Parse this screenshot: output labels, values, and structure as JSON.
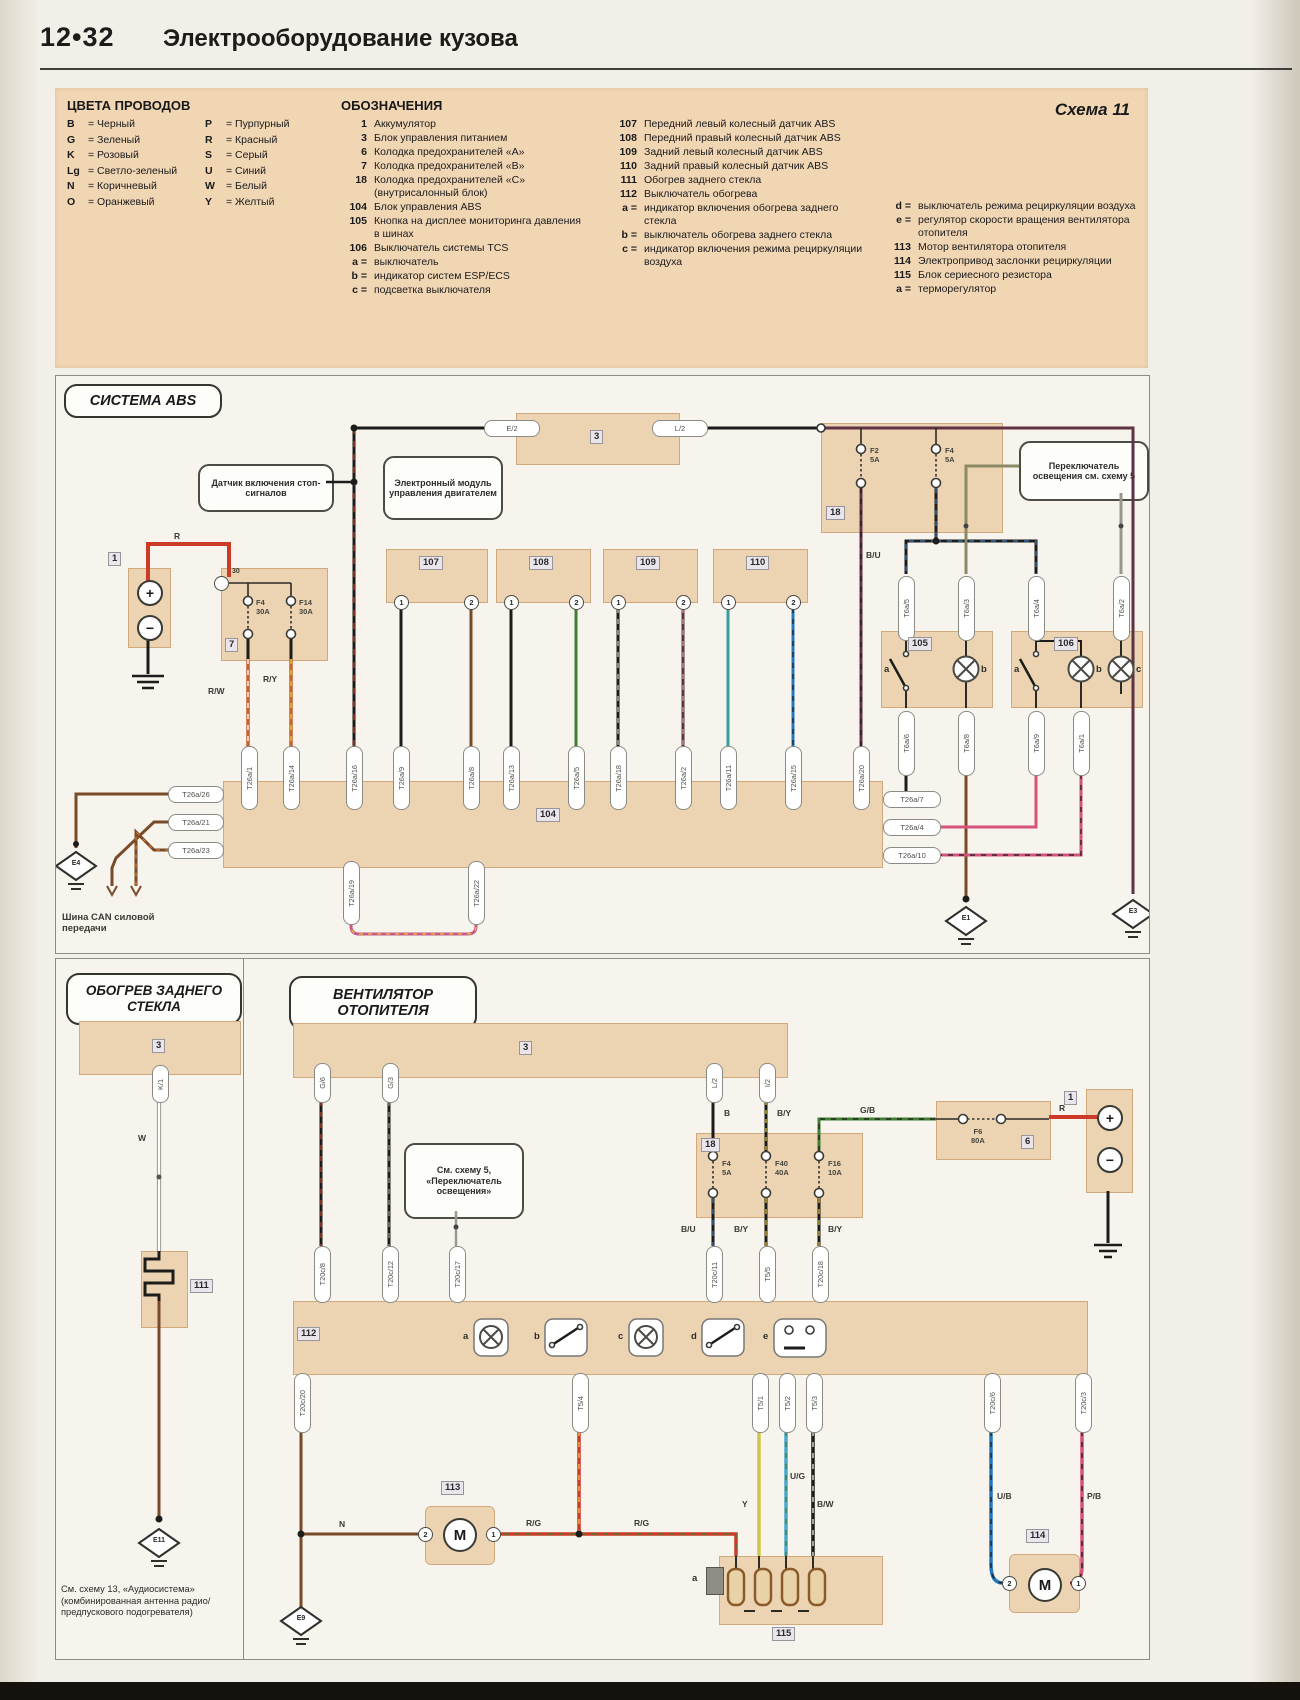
{
  "header": {
    "page_no": "12•32",
    "title": "Электрооборудование кузова"
  },
  "sym": {
    "plus": "+",
    "minus": "−",
    "m": "M"
  },
  "legend": {
    "scheme_label": "Схема 11",
    "wire_colors_title": "ЦВЕТА ПРОВОДОВ",
    "designations_title": "ОБОЗНАЧЕНИЯ",
    "wire_colors_col1": [
      {
        "code": "B",
        "name": "= Черный"
      },
      {
        "code": "G",
        "name": "= Зеленый"
      },
      {
        "code": "K",
        "name": "= Розовый"
      },
      {
        "code": "Lg",
        "name": "= Светло-зеленый"
      },
      {
        "code": "N",
        "name": "= Коричневый"
      },
      {
        "code": "O",
        "name": "= Оранжевый"
      }
    ],
    "wire_colors_col2": [
      {
        "code": "P",
        "name": "= Пурпурный"
      },
      {
        "code": "R",
        "name": "= Красный"
      },
      {
        "code": "S",
        "name": "= Серый"
      },
      {
        "code": "U",
        "name": "= Синий"
      },
      {
        "code": "W",
        "name": "= Белый"
      },
      {
        "code": "Y",
        "name": "= Желтый"
      }
    ],
    "designations_col1": [
      {
        "n": "1",
        "t": "Аккумулятор"
      },
      {
        "n": "3",
        "t": "Блок управления питанием"
      },
      {
        "n": "6",
        "t": "Колодка предохранителей «А»"
      },
      {
        "n": "7",
        "t": "Колодка предохранителей «В»"
      },
      {
        "n": "18",
        "t": "Колодка предохранителей «С» (внутрисалонный блок)"
      },
      {
        "n": "104",
        "t": "Блок управления ABS"
      },
      {
        "n": "105",
        "t": "Кнопка на дисплее мониторинга давления в шинах"
      },
      {
        "n": "106",
        "t": "Выключатель системы TCS"
      },
      {
        "n": "a =",
        "t": "выключатель"
      },
      {
        "n": "b =",
        "t": "индикатор систем ESP/ECS"
      },
      {
        "n": "c =",
        "t": "подсветка выключателя"
      }
    ],
    "designations_col2": [
      {
        "n": "107",
        "t": "Передний левый колесный датчик ABS"
      },
      {
        "n": "108",
        "t": "Передний правый колесный датчик ABS"
      },
      {
        "n": "109",
        "t": "Задний левый колесный датчик ABS"
      },
      {
        "n": "110",
        "t": "Задний правый колесный датчик ABS"
      },
      {
        "n": "111",
        "t": "Обогрев заднего стекла"
      },
      {
        "n": "112",
        "t": "Выключатель обогрева"
      },
      {
        "n": "a =",
        "t": "индикатор включения обогрева заднего стекла"
      },
      {
        "n": "b =",
        "t": "выключатель обогрева заднего стекла"
      },
      {
        "n": "c =",
        "t": "индикатор включения режима рециркуляции воздуха"
      }
    ],
    "designations_col3": [
      {
        "n": "d =",
        "t": "выключатель режима рециркуляции воздуха"
      },
      {
        "n": "e =",
        "t": "регулятор скорости вращения вентилятора отопителя"
      },
      {
        "n": "113",
        "t": "Мотор вентилятора отопителя"
      },
      {
        "n": "114",
        "t": "Электропривод заслонки рециркуляции"
      },
      {
        "n": "115",
        "t": "Блок сериесного резистора"
      },
      {
        "n": "a =",
        "t": "терморегулятор"
      }
    ]
  },
  "abs": {
    "section_title": "СИСТЕМА ABS",
    "callout_stop": "Датчик включения стоп-сигналов",
    "callout_ecm": "Электронный модуль управления двигателем",
    "callout_light": "Переключатель освещения см. схему 5",
    "blocks": {
      "battery": "1",
      "fusebox7": "7",
      "power3": "3",
      "fusebox18": "18",
      "ctrl104": "104",
      "disp105": "105",
      "tcs106": "106",
      "s107": "107",
      "s108": "108",
      "s109": "109",
      "s110": "110"
    },
    "pins": {
      "p30": "30",
      "e2": "E/2",
      "l2": "L/2",
      "pin1": "1",
      "pin2": "2"
    },
    "fuses": {
      "f4": "F4",
      "f4a": "30A",
      "f14": "F14",
      "f14a": "30A",
      "f2": "F2",
      "f2a": "5A",
      "f4b": "F4",
      "f4ba": "5A"
    },
    "wire_labels": {
      "r": "R",
      "rw": "R/W",
      "ry": "R/Y",
      "bu": "B/U"
    },
    "connectors_top": [
      "T26a/1",
      "T26a/14",
      "T26a/16",
      "T26a/9",
      "T26a/8",
      "T26a/13",
      "T26a/5",
      "T26a/18",
      "T26a/2",
      "T26a/11",
      "T26a/15",
      "T26a/20"
    ],
    "connectors_left": [
      "T26a/26",
      "T26a/21",
      "T26a/23"
    ],
    "connectors_right": [
      "T26a/7",
      "T26a/4",
      "T26a/10"
    ],
    "connectors_bottom": [
      "T26a/19",
      "T26a/22"
    ],
    "sw_top": [
      "T6a/5",
      "T6a/3",
      "T6a/4",
      "T6a/2"
    ],
    "sw_bottom": [
      "T6a/6",
      "T6a/8",
      "T6a/9",
      "T6a/1"
    ],
    "sw_letters": {
      "a": "a",
      "b": "b",
      "c": "c"
    },
    "grounds": {
      "e4": "E4",
      "e1": "E1",
      "e3": "E3"
    },
    "can_label": "Шина CAN силовой передачи"
  },
  "heater": {
    "section_title": "ОБОГРЕВ ЗАДНЕГО СТЕКЛА",
    "block3": "3",
    "k1": "K/1",
    "w": "W",
    "block111": "111",
    "ground": "E11",
    "note": "См. схему 13, «Аудиосистема» (комбинированная антенна радио/предпускового подогревателя)"
  },
  "fan": {
    "section_title": "ВЕНТИЛЯТОР ОТОПИТЕЛЯ",
    "callout": "См. схему 5, «Переключатель освещения»",
    "blocks": {
      "bar3": "3",
      "fusebox18": "18",
      "fusebox6": "6",
      "battery": "1",
      "sw112": "112",
      "motor113": "113",
      "motor114": "114",
      "res115": "115"
    },
    "conn_top": [
      "G/6",
      "G/3",
      "L/2",
      "I/2"
    ],
    "conn112_top": [
      "T20c/8",
      "T20c/12",
      "T20c/17",
      "T20c/11",
      "T5/5",
      "T20c/18"
    ],
    "conn112_bottom": [
      "T20c/20",
      "T5/4",
      "T5/1",
      "T5/2",
      "T5/3",
      "T20c/6",
      "T20c/3"
    ],
    "fuses": {
      "f4": "F4",
      "f4a": "5A",
      "f40": "F40",
      "f40a": "40A",
      "f16": "F16",
      "f16a": "10A",
      "f6": "F6",
      "f6a": "80A"
    },
    "wire_labels": {
      "b": "B",
      "by": "B/Y",
      "gb": "G/B",
      "bu": "B/U",
      "by2": "B/Y",
      "by3": "B/Y",
      "r": "R",
      "n": "N",
      "rg": "R/G",
      "y": "Y",
      "ug": "U/G",
      "bw": "B/W",
      "ub": "U/B",
      "pb": "P/B"
    },
    "letters": [
      "a",
      "b",
      "c",
      "d",
      "e"
    ],
    "pin1": "1",
    "pin2": "2",
    "t115a": "a",
    "grounds": {
      "e9": "E9"
    }
  }
}
